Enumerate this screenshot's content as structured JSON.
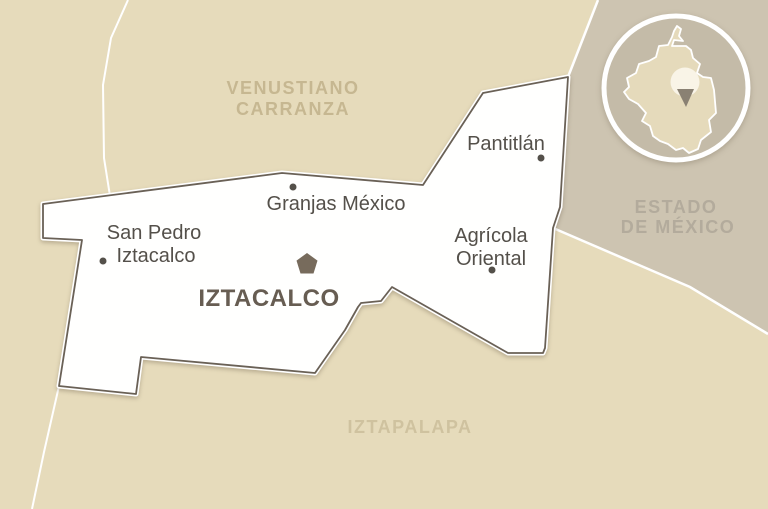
{
  "map": {
    "main_region": {
      "name": "IZTACALCO",
      "symbol": "pentagon"
    },
    "neighbor_regions": {
      "north_line1": "VENUSTIANO",
      "north_line2": "CARRANZA",
      "south": "IZTAPALAPA",
      "east_line1": "ESTADO",
      "east_line2": "DE MÉXICO"
    },
    "places": {
      "pantitlan": "Pantitlán",
      "granjas_mexico": "Granjas México",
      "san_pedro_line1": "San Pedro",
      "san_pedro_line2": "Iztacalco",
      "agricola_line1": "Agrícola",
      "agricola_line2": "Oriental"
    },
    "inset": {
      "depicts": "cdmx-silhouette-with-location-marker"
    }
  },
  "colors": {
    "background_beige": "#e6dbbb",
    "estado_gray": "#cdc4b1",
    "inset_inner_gray": "#c4bba8",
    "cdmx_fill": "#e5dabb",
    "iztacalco_fill": "#fffffe",
    "border_dark": "#6a6156",
    "boundary_white": "#ffffff",
    "neighbor_label": "#c6b791",
    "iztapalapa_label": "#cfc29f",
    "estado_label": "#b3ab9c",
    "place_label": "#54504a",
    "main_label": "#675d52",
    "pentagon_fill": "#776b5c",
    "marker_circle_fill": "#f9f4e7",
    "marker_triangle": "#8a8173"
  }
}
